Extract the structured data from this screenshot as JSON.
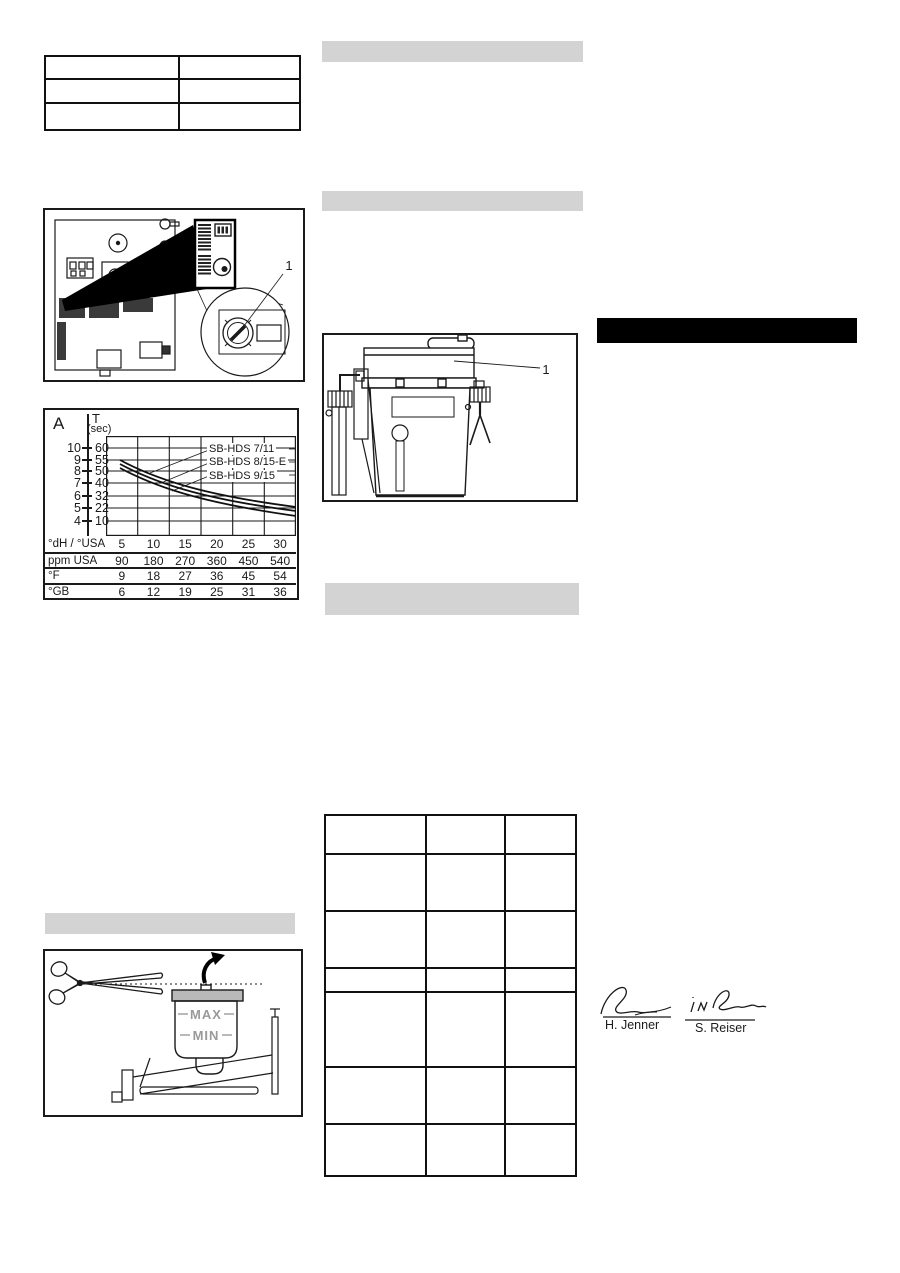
{
  "colors": {
    "ink": "#1a1a1a",
    "section_bar_gray": "#d3d3d3",
    "redaction_black": "#000000",
    "container_lid_gray": "#b9b9b9",
    "maxmin_text_gray": "#9a9a9a"
  },
  "figures": {
    "circuit_board": {
      "callout_label": "1"
    },
    "detergent_tank": {
      "callout_label": "1"
    },
    "float_container": {
      "max_label": "MAX",
      "min_label": "MIN"
    }
  },
  "chart_data": {
    "type": "line",
    "title": "",
    "grid": true,
    "legend_position": "inline-labels",
    "y_axis_left": {
      "label": "A",
      "ticks": [
        "10",
        "9",
        "8",
        "7",
        "6",
        "5",
        "4"
      ]
    },
    "y_axis_right": {
      "label": "T",
      "unit": "(sec)",
      "ticks": [
        "60",
        "55",
        "50",
        "40",
        "32",
        "22",
        "10"
      ]
    },
    "x_axis": {
      "label": "°dH / °USA",
      "ticks": [
        "5",
        "10",
        "15",
        "20",
        "25",
        "30"
      ]
    },
    "series": [
      {
        "name": "SB-HDS 7/11",
        "x": [
          5,
          10,
          15,
          20,
          25,
          30
        ],
        "a_values": [
          8.8,
          7.4,
          6.4,
          5.8,
          5.3,
          5.0
        ]
      },
      {
        "name": "SB-HDS 8/15-E",
        "x": [
          5,
          10,
          15,
          20,
          25,
          30
        ],
        "a_values": [
          8.6,
          7.2,
          6.2,
          5.5,
          5.0,
          4.7
        ]
      },
      {
        "name": "SB-HDS 9/15",
        "x": [
          5,
          10,
          15,
          20,
          25,
          30
        ],
        "a_values": [
          8.4,
          7.0,
          6.0,
          5.2,
          4.7,
          4.4
        ]
      }
    ],
    "conversion_table": {
      "rows": [
        {
          "label": "°dH / °USA",
          "values": [
            "5",
            "10",
            "15",
            "20",
            "25",
            "30"
          ]
        },
        {
          "label": "ppm USA",
          "values": [
            "90",
            "180",
            "270",
            "360",
            "450",
            "540"
          ]
        },
        {
          "label": "°F",
          "values": [
            "9",
            "18",
            "27",
            "36",
            "45",
            "54"
          ]
        },
        {
          "label": "°GB",
          "values": [
            "6",
            "12",
            "19",
            "25",
            "31",
            "36"
          ]
        }
      ]
    }
  },
  "signatures": {
    "left": "H. Jenner",
    "right": "S. Reiser"
  }
}
